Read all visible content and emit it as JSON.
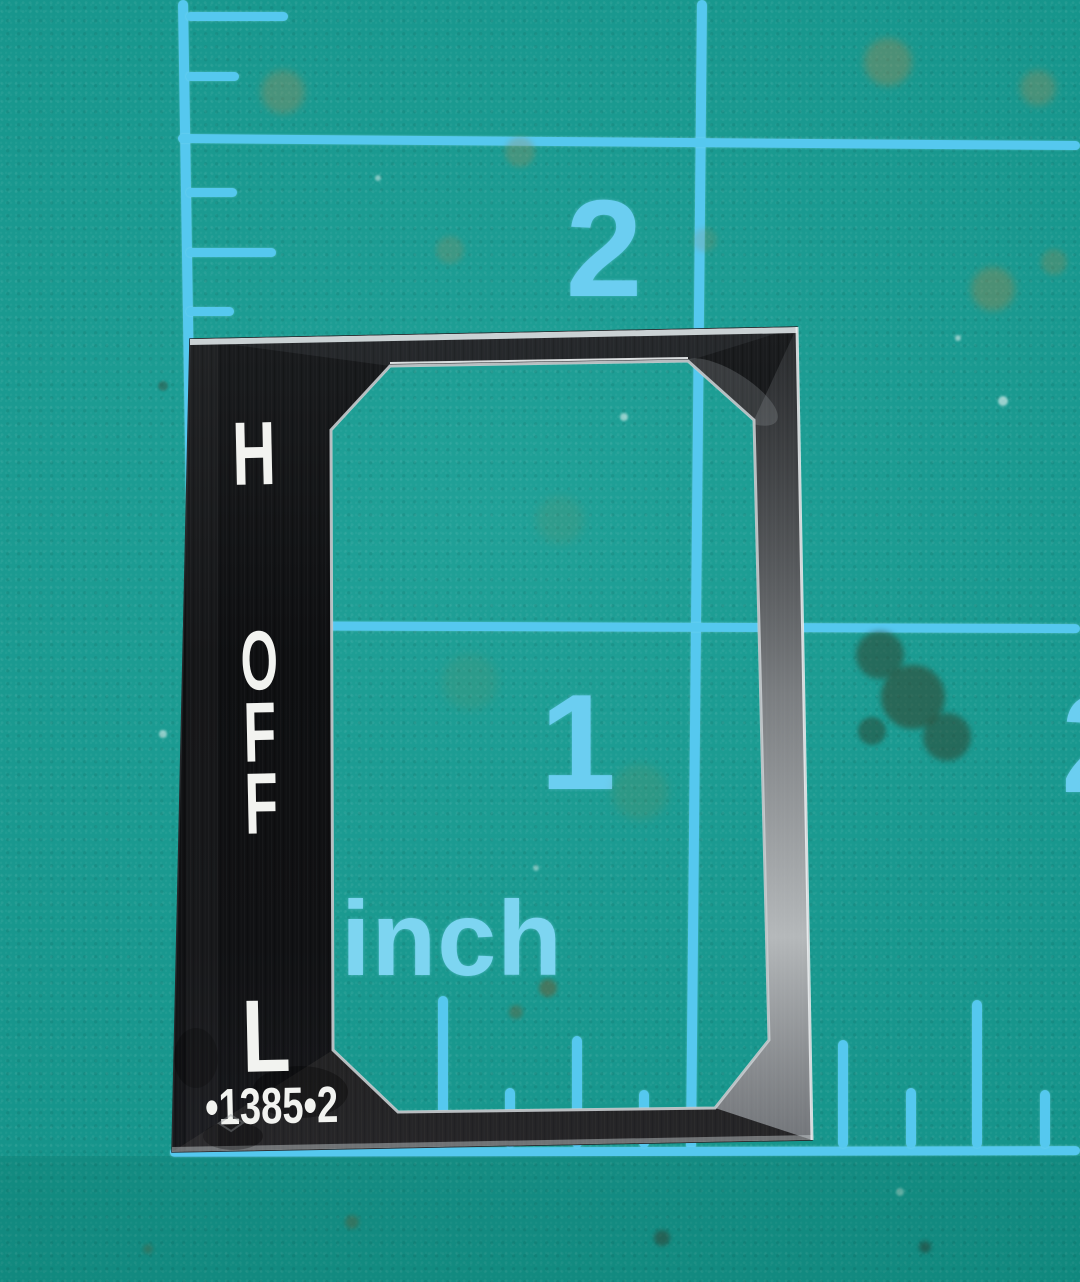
{
  "scene": {
    "subject": "black metal switch faceplate lying on a teal cutting mat"
  },
  "mat": {
    "surface_color": "#149c92",
    "grid_color": "#55c8ef",
    "unit_label": "inch",
    "gridlines": {
      "vertical": [
        {
          "x": 178,
          "y1": 0,
          "y2": 1156,
          "tilt": -0.9
        },
        {
          "x": 697,
          "y1": 0,
          "y2": 1150,
          "tilt": 0.55
        }
      ],
      "horizontal": [
        {
          "y": 134,
          "x1": 178,
          "x2": 1080,
          "tilt": 0.45
        },
        {
          "y": 621,
          "x1": 183,
          "x2": 1080,
          "tilt": 0.2
        },
        {
          "y": 1148,
          "x1": 170,
          "x2": 1080,
          "tilt": -0.12
        }
      ]
    },
    "edge_ticks_left": {
      "attach_x": 186,
      "items": [
        {
          "y": 12,
          "len": 102
        },
        {
          "y": 72,
          "len": 53
        },
        {
          "y": 188,
          "len": 51
        },
        {
          "y": 248,
          "len": 90
        },
        {
          "y": 307,
          "len": 48
        }
      ]
    },
    "edge_ticks_bottom": {
      "attach_y": 1148,
      "items": [
        {
          "x": 438,
          "len": 152
        },
        {
          "x": 505,
          "len": 60
        },
        {
          "x": 572,
          "len": 112
        },
        {
          "x": 639,
          "len": 58
        },
        {
          "x": 838,
          "len": 108
        },
        {
          "x": 906,
          "len": 60
        },
        {
          "x": 972,
          "len": 148
        },
        {
          "x": 1040,
          "len": 58
        }
      ]
    },
    "numbers": [
      {
        "text": "2",
        "x": 604,
        "y": 249,
        "size": 138
      },
      {
        "text": "1",
        "x": 578,
        "y": 742,
        "size": 136
      },
      {
        "text": "2",
        "x": 1100,
        "y": 744,
        "size": 140
      }
    ],
    "stains": [
      {
        "x": 283,
        "y": 92,
        "r": 22,
        "c": "#a08a58",
        "o": 0.35,
        "b": 4
      },
      {
        "x": 520,
        "y": 152,
        "r": 15,
        "c": "#a08a58",
        "o": 0.3,
        "b": 3
      },
      {
        "x": 1038,
        "y": 88,
        "r": 18,
        "c": "#a08a58",
        "o": 0.35,
        "b": 4
      },
      {
        "x": 888,
        "y": 62,
        "r": 24,
        "c": "#9a8755",
        "o": 0.4,
        "b": 4
      },
      {
        "x": 993,
        "y": 289,
        "r": 22,
        "c": "#96854f",
        "o": 0.4,
        "b": 4
      },
      {
        "x": 1054,
        "y": 262,
        "r": 13,
        "c": "#96854f",
        "o": 0.3,
        "b": 3
      },
      {
        "x": 450,
        "y": 250,
        "r": 14,
        "c": "#a08a58",
        "o": 0.25,
        "b": 3
      },
      {
        "x": 705,
        "y": 240,
        "r": 12,
        "c": "#a08a58",
        "o": 0.2,
        "b": 3
      },
      {
        "x": 640,
        "y": 792,
        "r": 28,
        "c": "#7c8a50",
        "o": 0.18,
        "b": 5
      },
      {
        "x": 560,
        "y": 520,
        "r": 24,
        "c": "#8a8a55",
        "o": 0.15,
        "b": 5
      },
      {
        "x": 470,
        "y": 682,
        "r": 28,
        "c": "#7f8a52",
        "o": 0.14,
        "b": 5
      },
      {
        "x": 880,
        "y": 655,
        "r": 24,
        "c": "#2f3d28",
        "o": 0.5,
        "b": 3
      },
      {
        "x": 913,
        "y": 697,
        "r": 32,
        "c": "#33402a",
        "o": 0.55,
        "b": 3
      },
      {
        "x": 947,
        "y": 737,
        "r": 24,
        "c": "#2f3d28",
        "o": 0.5,
        "b": 3
      },
      {
        "x": 872,
        "y": 731,
        "r": 14,
        "c": "#2a3824",
        "o": 0.45,
        "b": 2
      },
      {
        "x": 548,
        "y": 988,
        "r": 9,
        "c": "#6b5a34",
        "o": 0.5,
        "b": 2
      },
      {
        "x": 516,
        "y": 1012,
        "r": 7,
        "c": "#6b5a34",
        "o": 0.4,
        "b": 2
      },
      {
        "x": 662,
        "y": 1238,
        "r": 8,
        "c": "#3a3c2e",
        "o": 0.5,
        "b": 2
      },
      {
        "x": 925,
        "y": 1247,
        "r": 6,
        "c": "#32342a",
        "o": 0.5,
        "b": 2
      },
      {
        "x": 352,
        "y": 1222,
        "r": 7,
        "c": "#6b5a34",
        "o": 0.4,
        "b": 2
      },
      {
        "x": 148,
        "y": 1249,
        "r": 5,
        "c": "#6b5a34",
        "o": 0.35,
        "b": 2
      },
      {
        "x": 163,
        "y": 386,
        "r": 5,
        "c": "#3a4434",
        "o": 0.4,
        "b": 1
      },
      {
        "x": 1003,
        "y": 401,
        "r": 5,
        "c": "#ffffff",
        "o": 0.55,
        "b": 1
      },
      {
        "x": 624,
        "y": 417,
        "r": 4,
        "c": "#ffffff",
        "o": 0.5,
        "b": 1
      },
      {
        "x": 163,
        "y": 734,
        "r": 4,
        "c": "#ffffff",
        "o": 0.5,
        "b": 1
      },
      {
        "x": 958,
        "y": 338,
        "r": 3,
        "c": "#ffffff",
        "o": 0.5,
        "b": 1
      },
      {
        "x": 378,
        "y": 178,
        "r": 3,
        "c": "#ffffff",
        "o": 0.45,
        "b": 1
      },
      {
        "x": 900,
        "y": 1192,
        "r": 4,
        "c": "#e8f4e8",
        "o": 0.4,
        "b": 1
      },
      {
        "x": 536,
        "y": 868,
        "r": 3,
        "c": "#ffffff",
        "o": 0.4,
        "b": 1
      }
    ]
  },
  "plate": {
    "labels": {
      "high": "H",
      "off": [
        "O",
        "F",
        "F"
      ],
      "low": "L",
      "part_number": "•1385•2"
    },
    "colors": {
      "body": "#101114",
      "rim": "#c8cdd0",
      "text": "#f2f3f0"
    }
  }
}
